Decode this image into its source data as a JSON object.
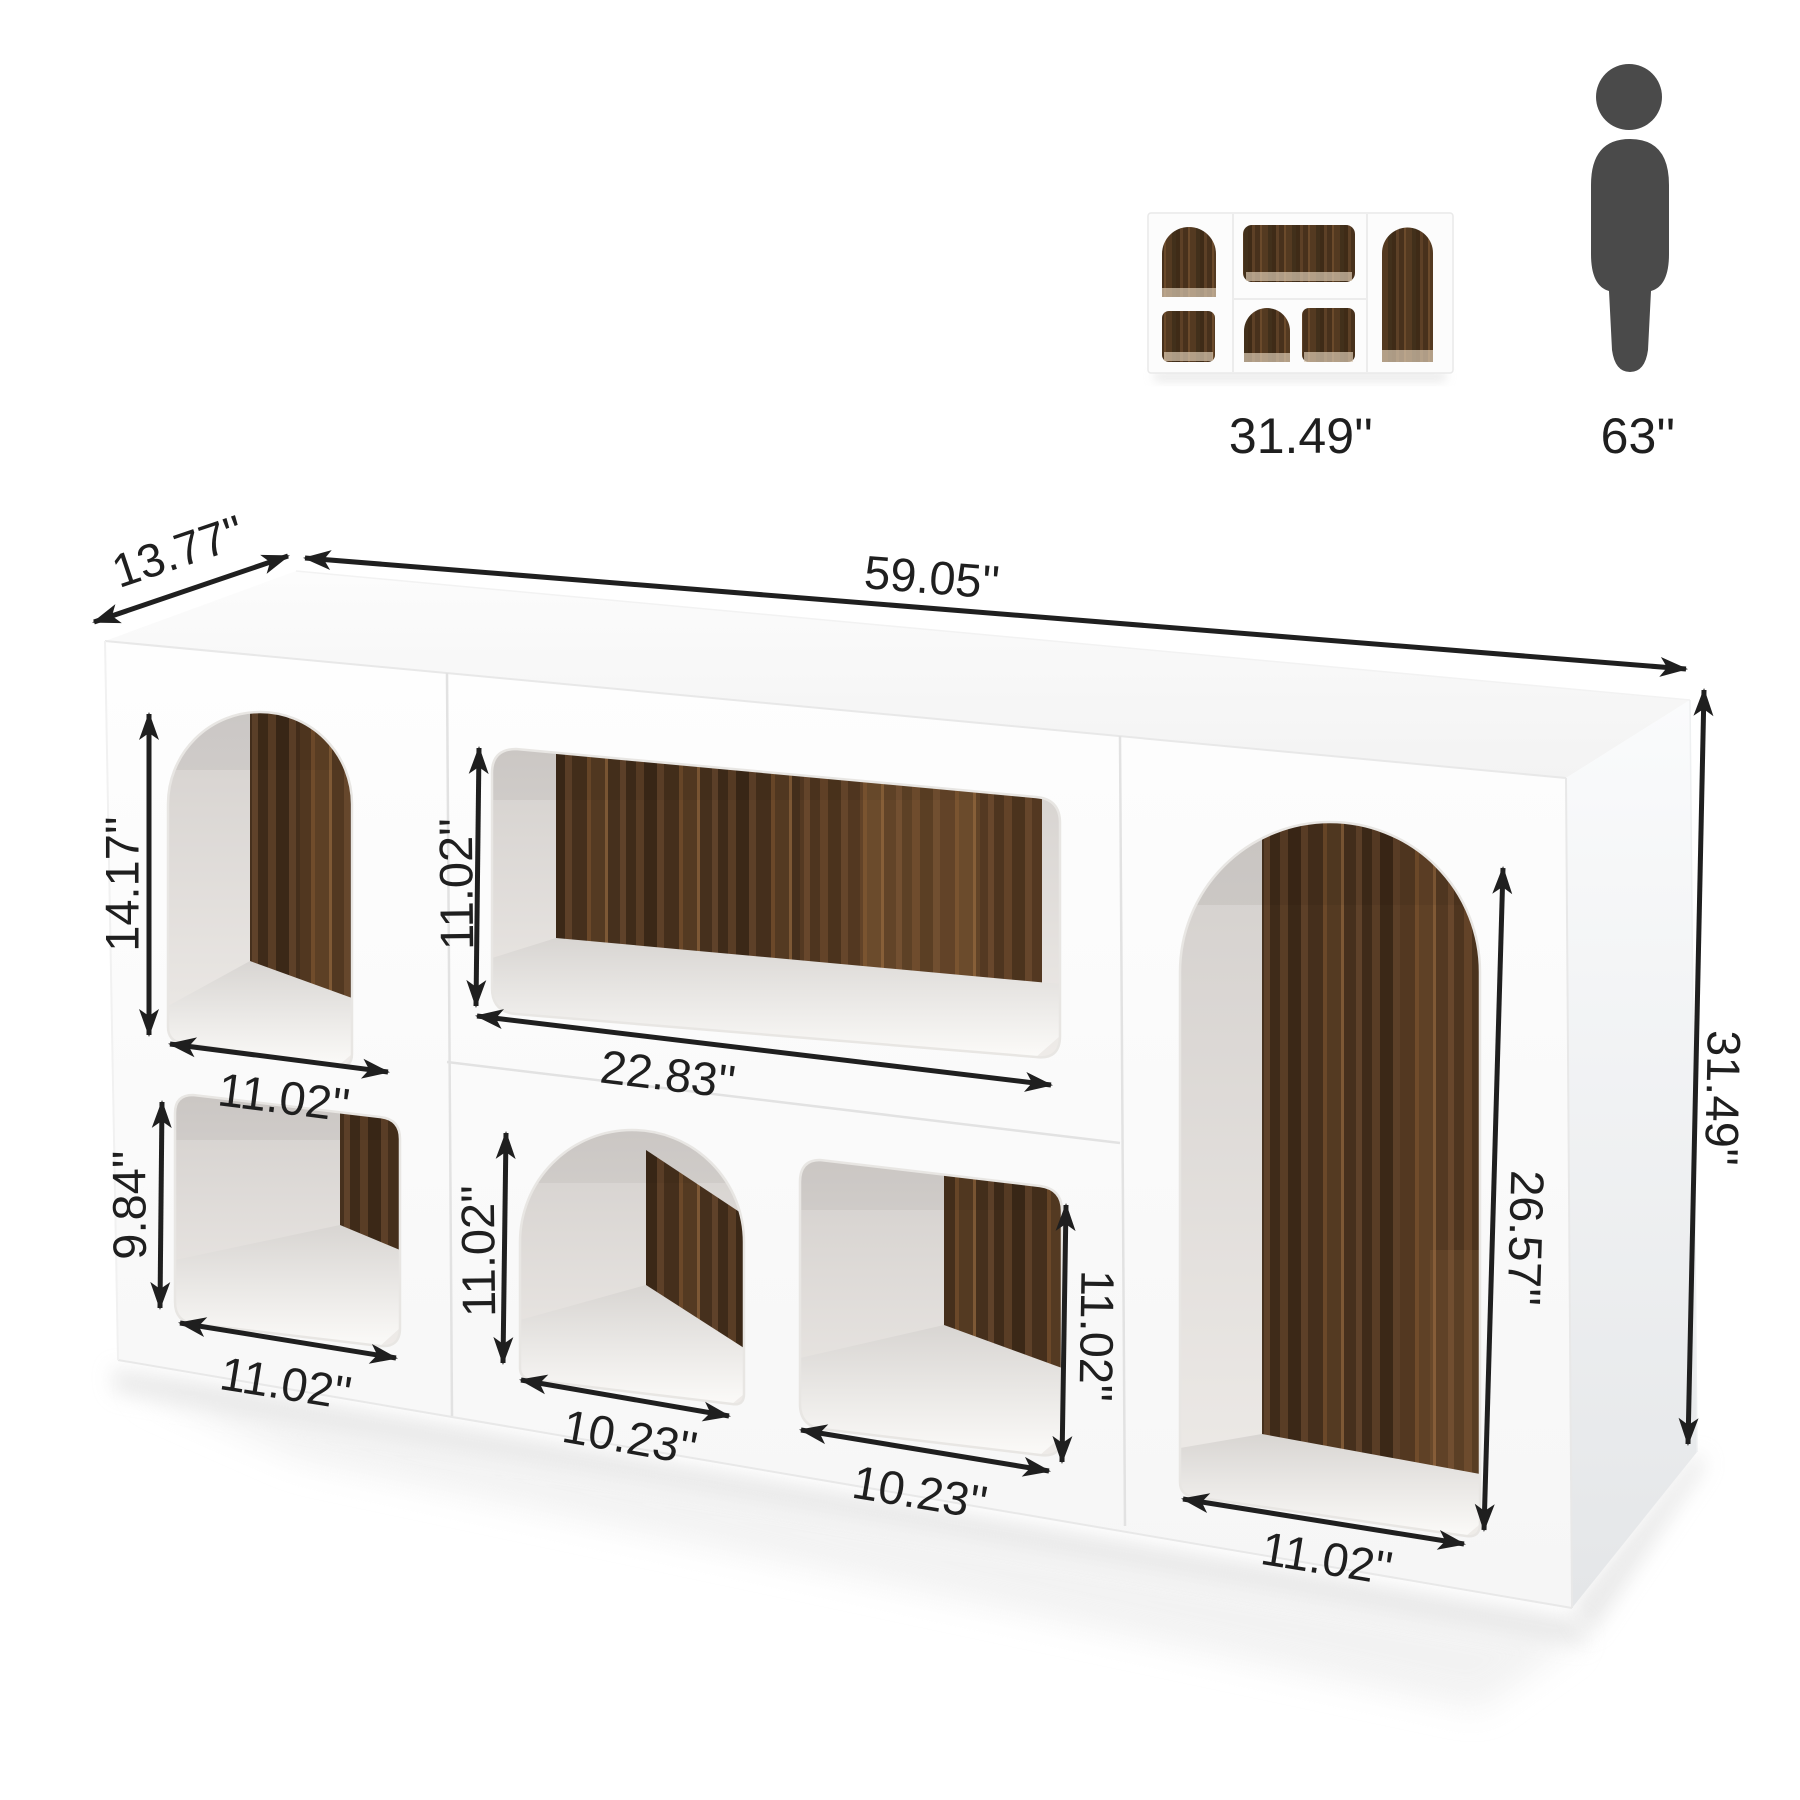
{
  "reference": {
    "unit": {
      "width_label": "31.49''"
    },
    "person": {
      "height_label": "63''"
    }
  },
  "dims": {
    "depth": "13.77''",
    "width": "59.05''",
    "height": "31.49''"
  },
  "openings": {
    "left_top_arch": {
      "height": "14.17''",
      "width": "11.02''"
    },
    "left_bottom_cubby": {
      "height": "9.84''",
      "width": "11.02''"
    },
    "center_top_shelf": {
      "height": "11.02''",
      "width": "22.83''"
    },
    "center_bottom_arch": {
      "height": "11.02''",
      "width": "10.23''"
    },
    "center_bottom_cubby": {
      "height": "11.02''",
      "width": "10.23''"
    },
    "right_arch": {
      "height": "26.57''",
      "width": "11.02''"
    }
  },
  "colors": {
    "ink": "#1f1f1f",
    "cabinet_white": "#fbfbfb",
    "wood_dark": "#3b2817",
    "wood_mid": "#4e3622",
    "wood_light": "#8a5f38",
    "person": "#4a4a4a",
    "background": "#ffffff"
  }
}
